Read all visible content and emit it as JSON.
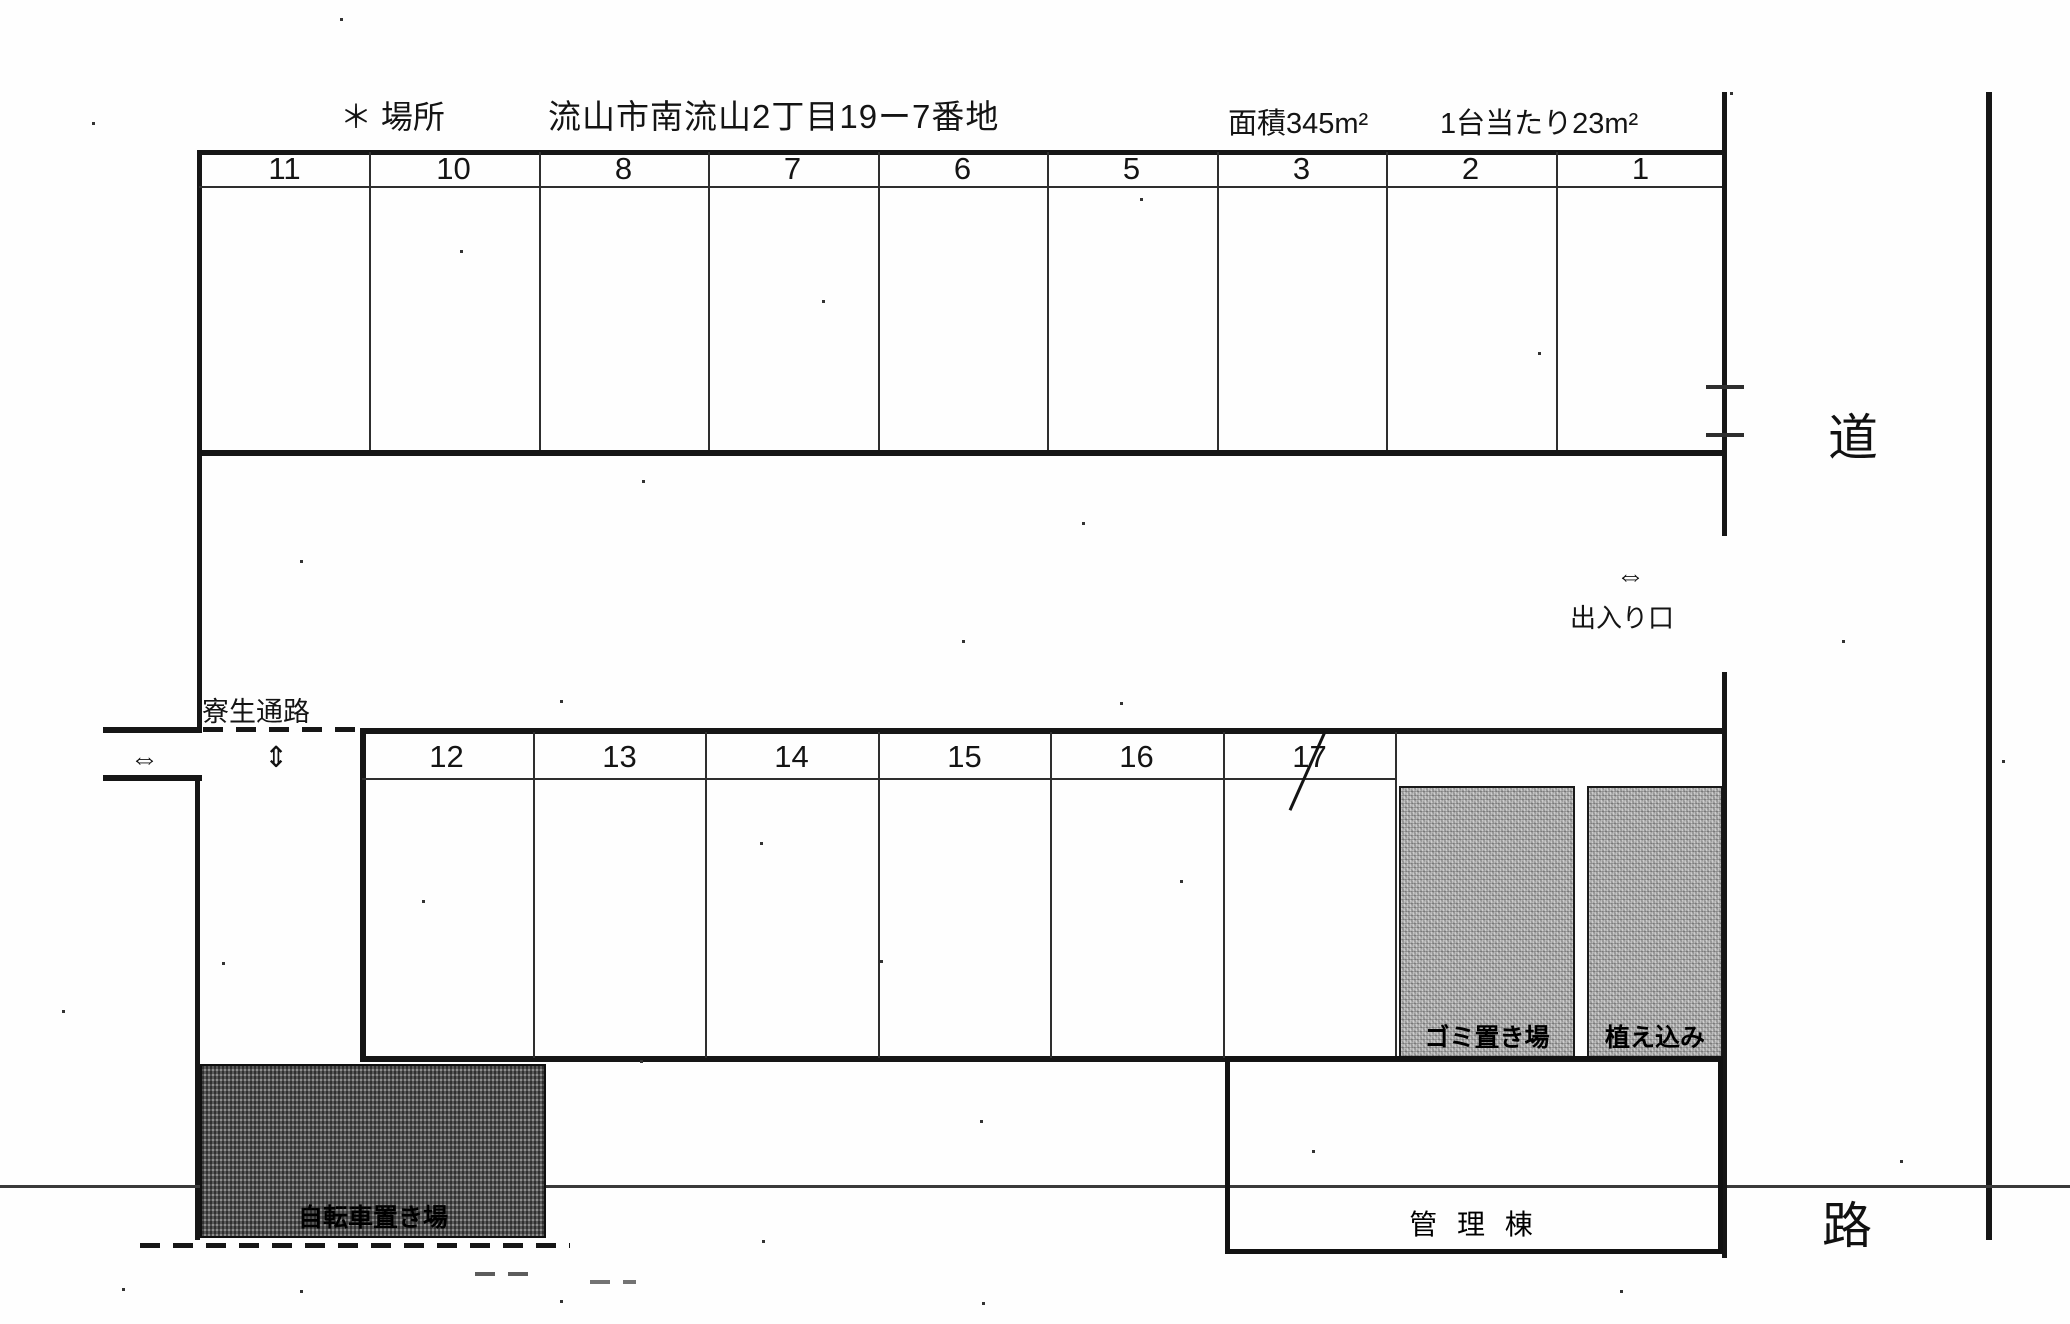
{
  "header": {
    "location_label": "＊ 場所",
    "address": "流山市南流山2丁目19ー7番地",
    "area": "面積345m²",
    "per_car": "1台当たり23m²"
  },
  "parking": {
    "top_row": [
      "11",
      "10",
      "8",
      "7",
      "6",
      "5",
      "3",
      "2",
      "1"
    ],
    "bottom_row": [
      "12",
      "13",
      "14",
      "15",
      "16",
      "17"
    ],
    "crossed_out_space": "17"
  },
  "labels": {
    "entrance": "出入り口",
    "entrance_arrow": "⇔",
    "passage": "寮生通路",
    "passage_arrow_horizontal": "⇔",
    "passage_arrow_vertical": "⇕",
    "road_char_top": "道",
    "road_char_bottom": "路",
    "garbage_area": "ゴミ置き場",
    "planting_area": "植え込み",
    "bicycle_parking": "自転車置き場",
    "management_building": "管 理 棟"
  },
  "colors": {
    "line": "#161616",
    "paper": "#fefefe",
    "hatch_light": "#a0a0a0",
    "hatch_dark": "#6a6a6a"
  }
}
